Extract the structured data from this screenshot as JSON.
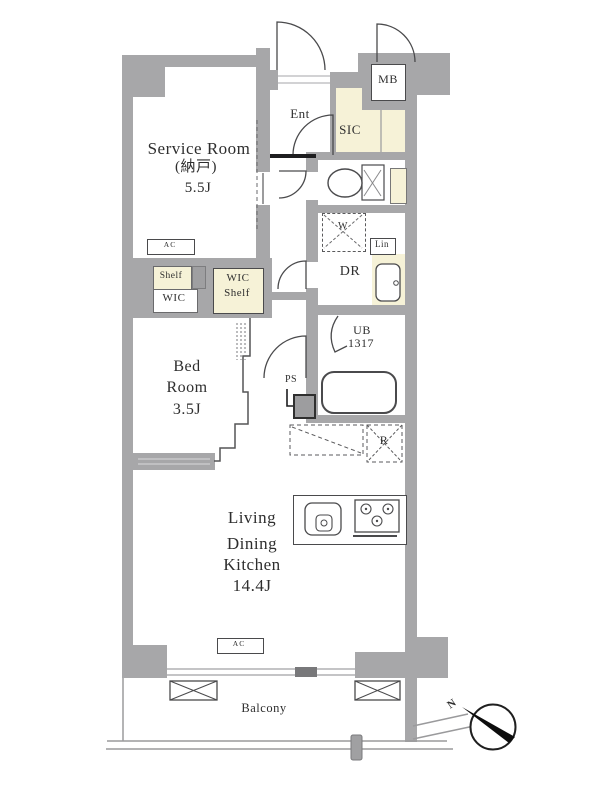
{
  "rooms": {
    "service_room": {
      "name": "Service Room",
      "alt_name": "(納戸)",
      "size": "5.5J"
    },
    "bed_room": {
      "word1": "Bed",
      "word2": "Room",
      "size": "3.5J"
    },
    "ldk": {
      "word1": "Living",
      "word2": "Dining",
      "word3": "Kitchen",
      "size": "14.4J"
    },
    "entrance": {
      "label": "Ent"
    },
    "sic": {
      "label": "SIC"
    },
    "dressing_room": {
      "label": "DR"
    },
    "unit_bath": {
      "label": "UB",
      "size": "1317"
    },
    "balcony": {
      "label": "Balcony"
    }
  },
  "fixtures": {
    "meter_box": "MB",
    "washer": "W",
    "linen": "Lin",
    "pipe_space": "PS",
    "refrigerator": "R",
    "shelf": "Shelf",
    "wic": "WIC",
    "wic_shelf_1": "WIC",
    "wic_shelf_2": "Shelf",
    "ac": "AC"
  },
  "compass": {
    "north": "N"
  },
  "colors": {
    "wall": "#a7a7a9",
    "highlight": "#f6f2d7",
    "line": "#4a4a4c",
    "background": "#ffffff"
  }
}
